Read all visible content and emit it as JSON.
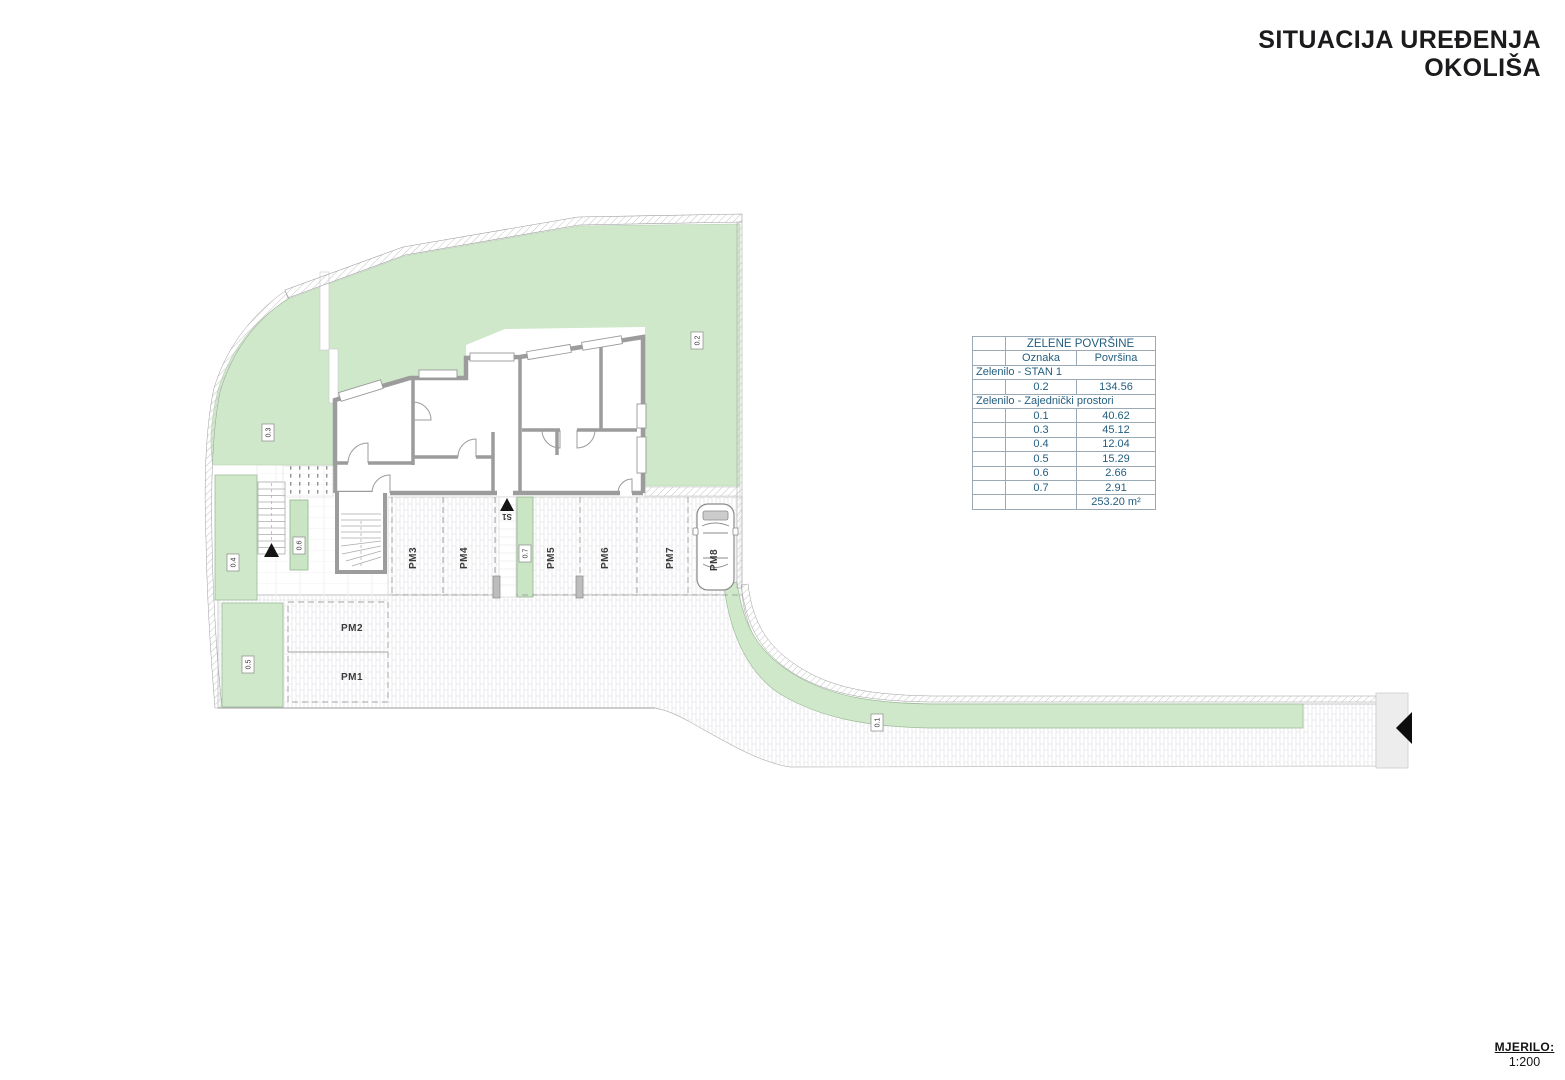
{
  "header": {
    "title_line1": "SITUACIJA UREĐENJA",
    "title_line2": "OKOLIŠA"
  },
  "scale_block": {
    "label": "MJERILO:",
    "value": "1:200"
  },
  "legend_table": {
    "title": "ZELENE POVRŠINE",
    "col_oznaka": "Oznaka",
    "col_povrsina": "Površina",
    "section1": "Zelenilo - STAN 1",
    "rows1": [
      {
        "oznaka": "0.2",
        "povrsina": "134.56"
      }
    ],
    "section2": "Zelenilo - Zajednički prostori",
    "rows2": [
      {
        "oznaka": "0.1",
        "povrsina": "40.62"
      },
      {
        "oznaka": "0.3",
        "povrsina": "45.12"
      },
      {
        "oznaka": "0.4",
        "povrsina": "12.04"
      },
      {
        "oznaka": "0.5",
        "povrsina": "15.29"
      },
      {
        "oznaka": "0.6",
        "povrsina": "2.66"
      },
      {
        "oznaka": "0.7",
        "povrsina": "2.91"
      }
    ],
    "total": "253.20 m²"
  },
  "plan": {
    "zones": {
      "z01": "0.1",
      "z02": "0.2",
      "z03": "0.3",
      "z04": "0.4",
      "z05": "0.5",
      "z06": "0.6",
      "z07": "0.7"
    },
    "parking": {
      "pm1": "PM1",
      "pm2": "PM2",
      "pm3": "PM3",
      "pm4": "PM4",
      "pm5": "PM5",
      "pm6": "PM6",
      "pm7": "PM7",
      "pm8": "PM8"
    },
    "stair_label": "S1"
  },
  "colors": {
    "green": "#cfe8ca",
    "wall_gray": "#9c9c9c",
    "table_text": "#235e80",
    "title_text": "#1b1b1d"
  }
}
